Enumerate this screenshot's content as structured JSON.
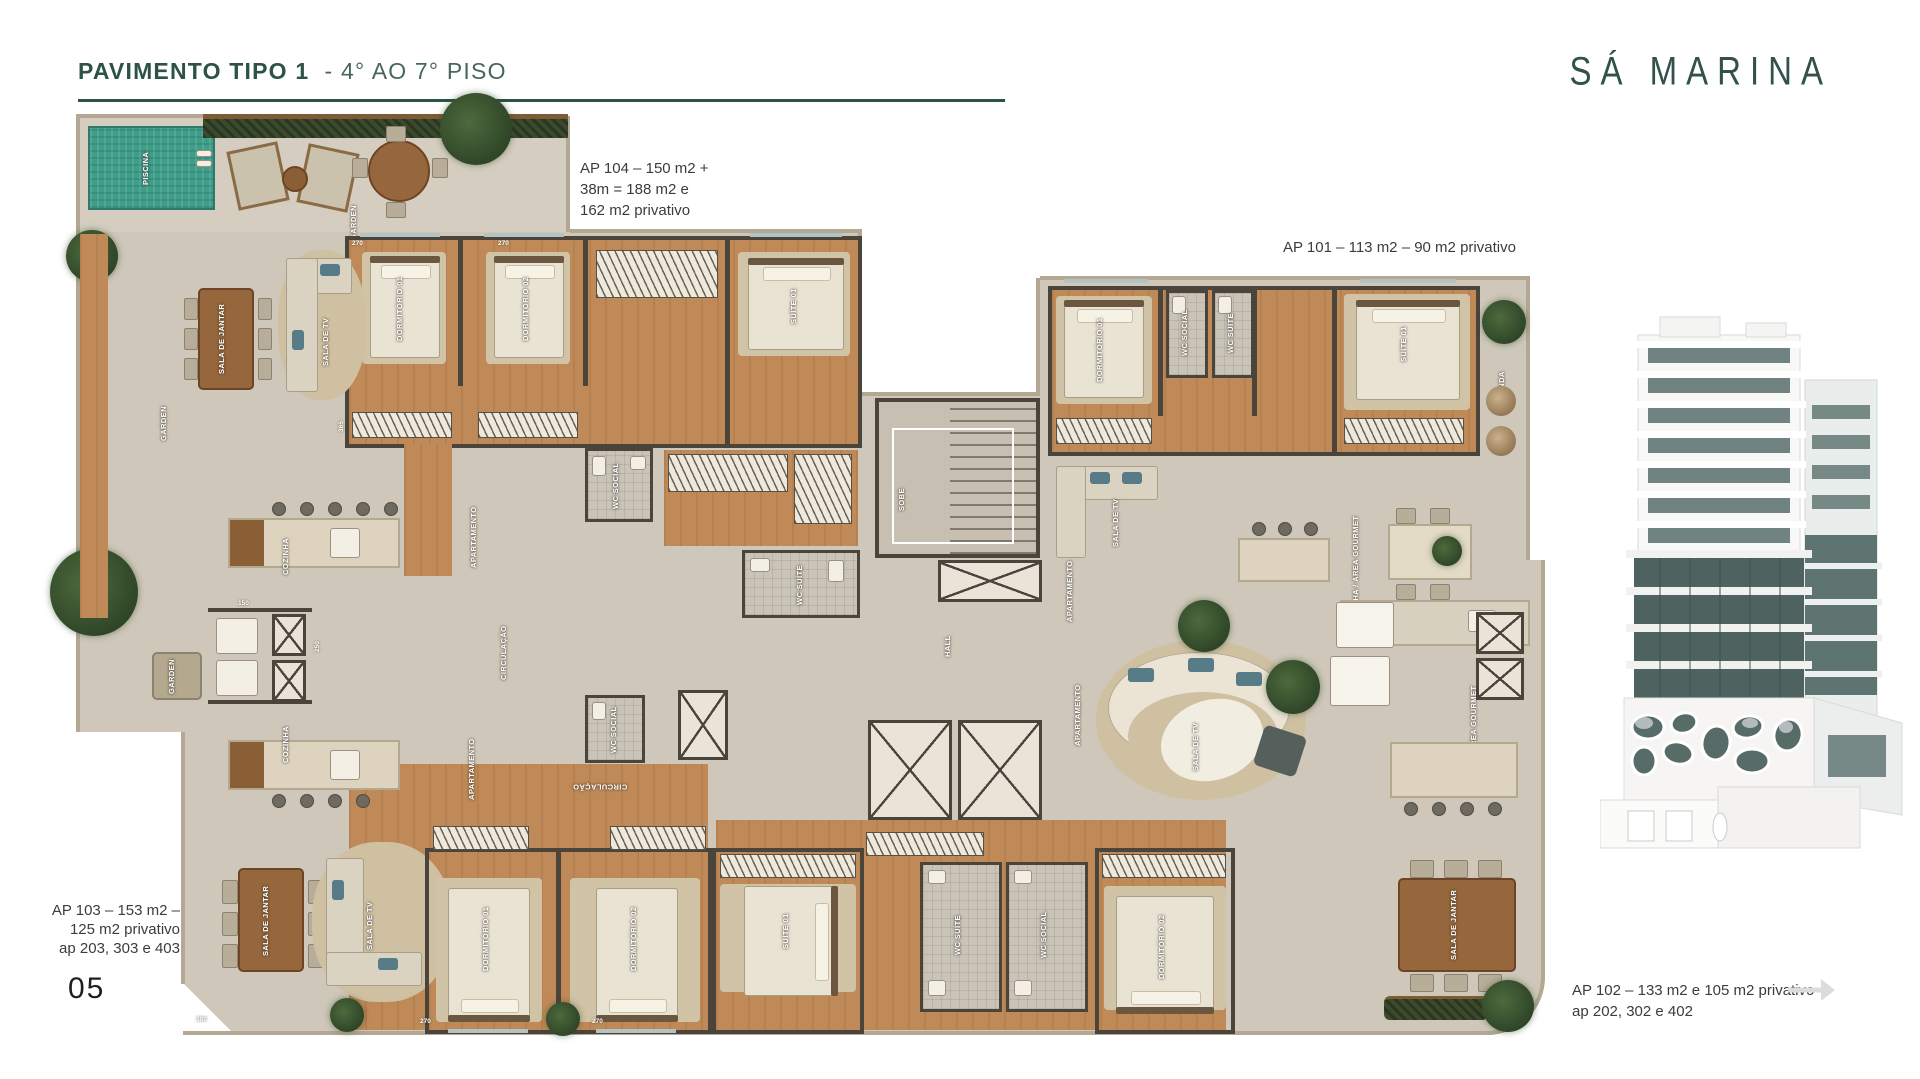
{
  "header": {
    "title_main": "PAVIMENTO TIPO 1",
    "title_sub": "- 4° AO 7° PISO",
    "brand": "SÁ MARINA"
  },
  "notes": {
    "ap104_l1": "AP 104 – 150 m2 +",
    "ap104_l2": "38m = 188 m2 e",
    "ap104_l3": "162 m2 privativo",
    "ap101": "AP 101 – 113 m2 – 90 m2 privativo",
    "ap103_l1": "AP 103 – 153 m2 –",
    "ap103_l2": "125 m2 privativo",
    "ap103_l3": "ap 203, 303 e 403",
    "ap102_l1": "AP 102 – 133 m2 e 105 m2 privativo",
    "ap102_l2": "ap 202, 302 e 402",
    "page": "05"
  },
  "rooms": {
    "piscina": "PISCINA",
    "garden": "GARDEN",
    "sala_jantar": "SALA DE JANTAR",
    "sala_tv": "SALA DE TV",
    "cozinha": "COZINHA",
    "cozinha_gourmet": "COZINHA / ÁREA GOURMET",
    "dorm1": "DORMITÓRIO 01",
    "dorm2": "DORMITÓRIO 02",
    "suite1": "SUÍTE 01",
    "circulacao": "CIRCULAÇÃO",
    "wc_social": "WC SOCIAL",
    "wc_suite": "WC SUÍTE",
    "hall": "HALL",
    "sobe": "SOBE",
    "varanda": "VARANDA",
    "apartamento": "APARTAMENTO"
  },
  "dims": [
    "270",
    "270",
    "365",
    "150",
    "250",
    "380",
    "270",
    "270"
  ],
  "colors": {
    "brand_green": "#2d5246",
    "pool_teal": "#3f9e8a",
    "wood": "#c08a58",
    "slab": "#cfc8ba",
    "glass_teal": "#4e6360"
  }
}
